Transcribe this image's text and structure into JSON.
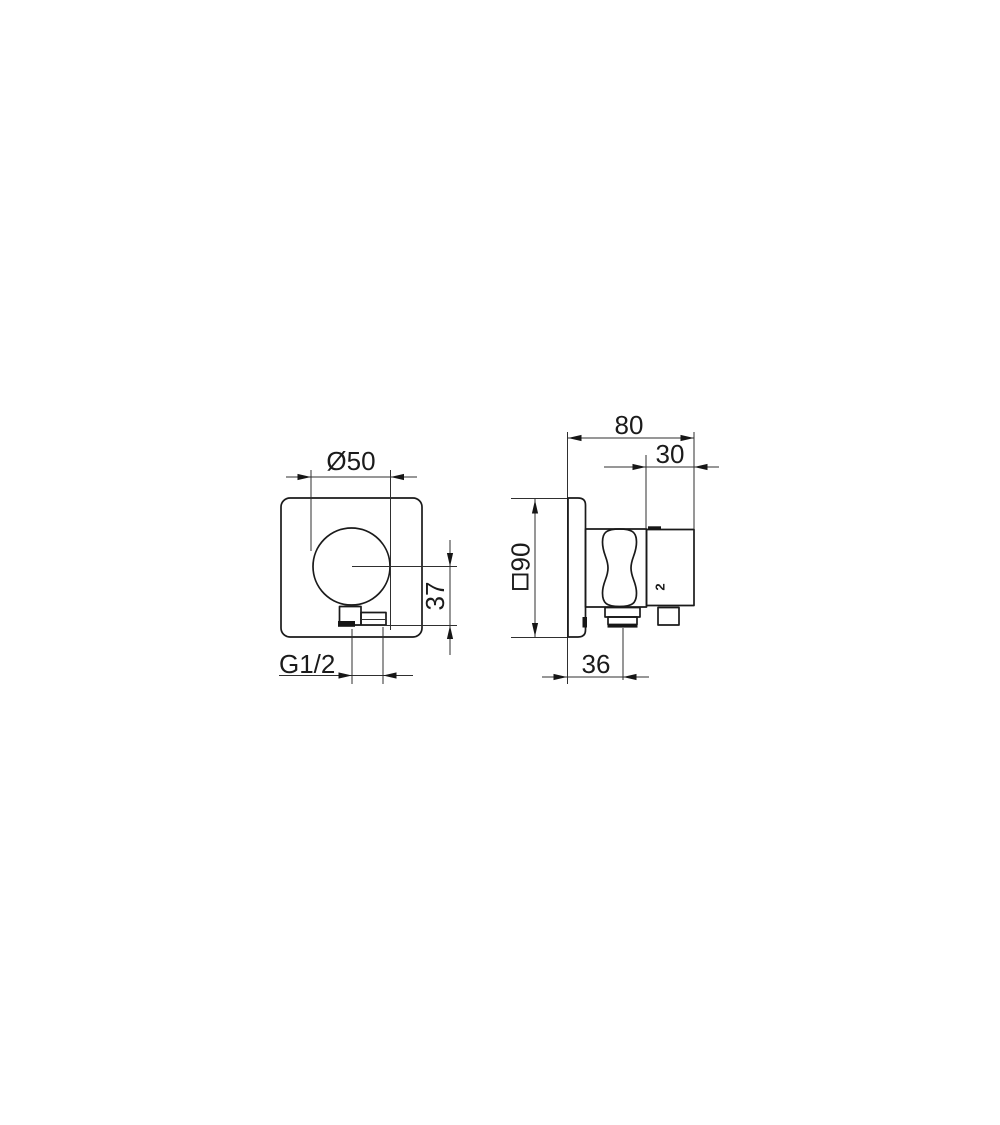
{
  "page": {
    "background": "#ffffff",
    "content": "technical dimension drawing, two views of a wall-mounted shower outlet with hand-shower holder"
  },
  "drawing": {
    "colors": {
      "object_line": "#1a1a1a",
      "dimension_line": "#2f2f2f",
      "text": "#1b1b1b"
    },
    "front_view": {
      "diameter_label": "Ø50",
      "height_offset_label": "37",
      "thread_label": "G1/2"
    },
    "side_view": {
      "total_depth_label": "80",
      "front_depth_label": "30",
      "plate_size_label": "90",
      "plate_size_symbol": "square-symbol",
      "outlet_offset_label": "36",
      "part_label": "2"
    }
  }
}
